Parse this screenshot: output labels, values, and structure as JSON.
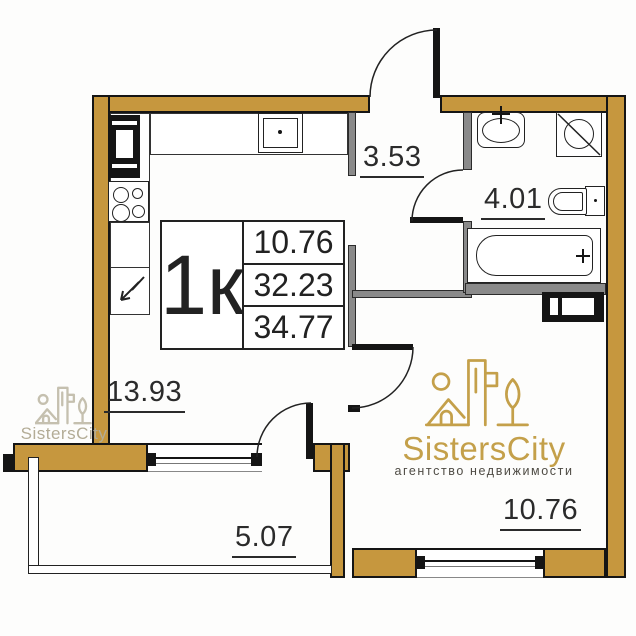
{
  "plan": {
    "unit_label": "1к",
    "area_values": [
      "10.76",
      "32.23",
      "34.77"
    ],
    "rooms": {
      "hallway": "3.53",
      "bathroom": "4.01",
      "kitchen_living": "13.93",
      "balcony": "5.07",
      "bedroom": "10.76"
    }
  },
  "branding": {
    "name": "SistersCity",
    "tagline": "агентство недвижимости",
    "watermark": "SistersCity"
  },
  "colors": {
    "wall_gold": "#C6973E",
    "interior_wall_gray": "#8A8A8A",
    "line_black": "#151515",
    "brand_gold": "#C4A04A",
    "tagline_gray": "#4F4C45",
    "watermark_faded": "#B3AC96"
  },
  "fixtures": [
    "fridge",
    "stove",
    "kitchen-sink",
    "kitchen-cabinet-arrow",
    "bath-sink",
    "washing-machine",
    "toilet",
    "bathtub",
    "vent-shaft"
  ]
}
